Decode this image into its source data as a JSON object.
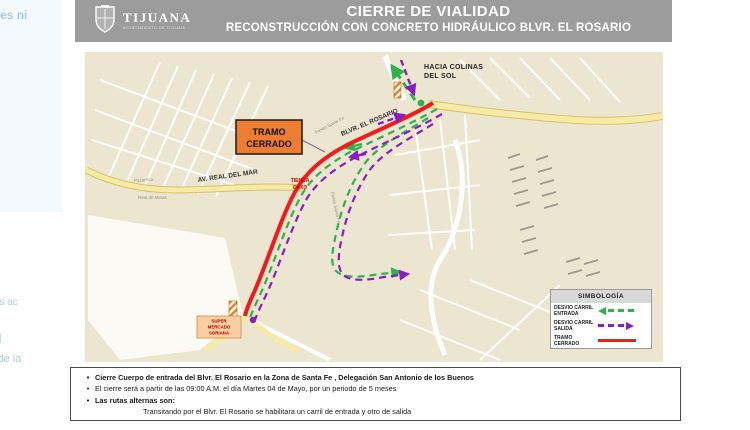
{
  "header": {
    "logo": {
      "name": "TIJUANA",
      "tagline": "AYUNTAMIENTO DE TIJUANA"
    },
    "title": "CIERRE DE VIALIDAD",
    "subtitle": "RECONSTRUCCIÓN CON CONCRETO HIDRÁULICO BLVR. EL ROSARIO"
  },
  "map": {
    "destination": {
      "line1": "HACIA COLINAS",
      "line2": "DEL SOL"
    },
    "closed_box": {
      "line1": "TRAMO",
      "line2": "CERRADO"
    },
    "roads": {
      "blvr": "BLVR. EL ROSARIO",
      "real_del_mar": "AV. REAL DEL MAR"
    },
    "pois": {
      "oxxo": {
        "line1": "TIENDA",
        "line2": "OXXO"
      },
      "supermarket": {
        "line1": "SUPER",
        "line2": "MERCADO",
        "line3": "SORIANA"
      }
    },
    "streets": {
      "s1": "Paseo Santa Fe",
      "s2": "Paseo Santa Fe",
      "s3": "Pozarrica",
      "s4": "Real de Minas"
    }
  },
  "legend": {
    "title": "SIMBOLOGÍA",
    "items": [
      {
        "label": "DESVIO CARRIL\nENTRADA",
        "color": "#2db34a",
        "style": "dashed-arrow-left"
      },
      {
        "label": "DESVIO CARRIL\nSALIDA",
        "color": "#8a1cc4",
        "style": "dashed-arrow-right"
      },
      {
        "label": "TRAMO  CERRADO",
        "color": "#ee1c1c",
        "style": "solid-line"
      }
    ]
  },
  "notes": {
    "bullets": [
      {
        "text": "Cierre Cuerpo de entrada del Blvr. El Rosario en la Zona de Santa Fe , Delegación San Antonio de los Buenos",
        "bold": true
      },
      {
        "text": "El cierre será a partir de las 09:00 A.M. el día Martes 04 de Mayo, por un periodo de 5 meses",
        "bold": false
      },
      {
        "text": "Las rutas alternas son:",
        "bold": true
      },
      {
        "text": "Transitando por el Blvr. El Rosario se habilitara  un carril de entrada y otro de salida",
        "bold": false
      }
    ]
  },
  "colors": {
    "header_bg": "#9c9c9c",
    "closed_route": "#ee1c1c",
    "entry_route": "#2db34a",
    "exit_route": "#8a1cc4",
    "closed_box_bg": "#ed7d31",
    "map_bg": "#ece5d0",
    "major_road": "#f6eba6"
  },
  "edge_fragments": {
    "f1": "enzajes ni",
    "f2": "o >",
    "f3": "spostes ac",
    "f4": "l",
    "f5": "corte de la"
  }
}
